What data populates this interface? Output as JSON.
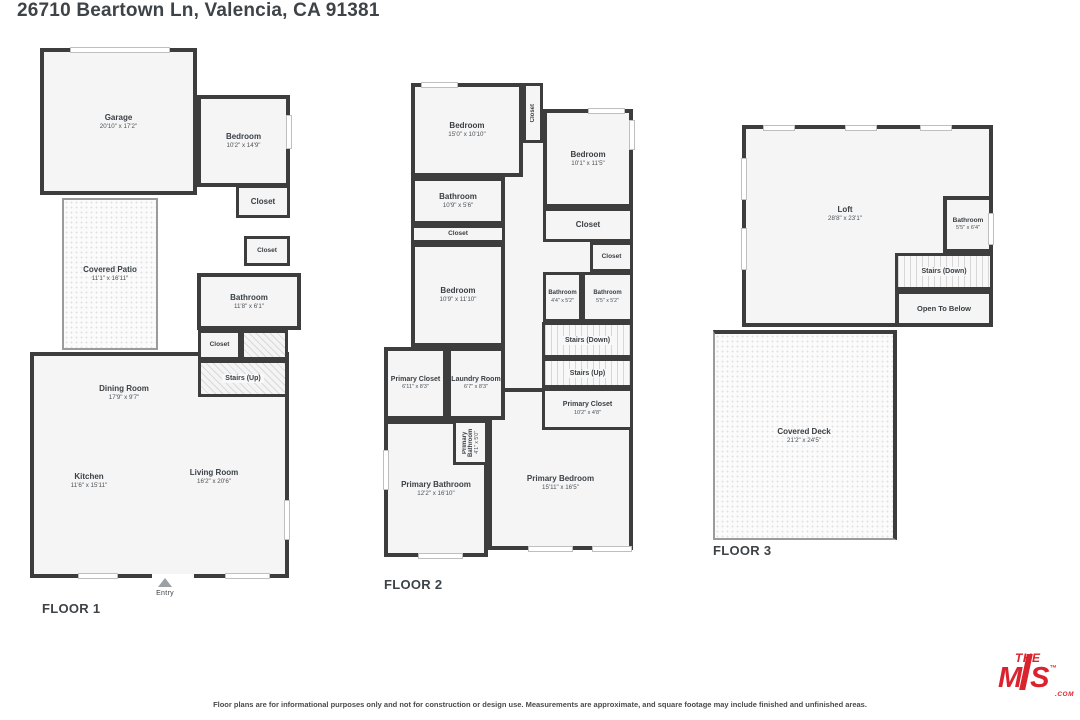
{
  "title": "26710 Beartown Ln, Valencia, CA 91381",
  "floors": [
    {
      "label": "FLOOR 1",
      "entry": "Entry",
      "rooms": [
        {
          "name": "Garage",
          "dims": "20'10\" x 17'2\""
        },
        {
          "name": "Bedroom",
          "dims": "10'2\" x 14'9\""
        },
        {
          "name": "Closet",
          "dims": ""
        },
        {
          "name": "Closet",
          "dims": ""
        },
        {
          "name": "Covered Patio",
          "dims": "11'1\" x 16'11\""
        },
        {
          "name": "Bathroom",
          "dims": "11'8\" x 6'1\""
        },
        {
          "name": "Closet",
          "dims": ""
        },
        {
          "name": "Stairs (Up)",
          "dims": ""
        },
        {
          "name": "Dining Room",
          "dims": "17'9\" x 9'7\""
        },
        {
          "name": "Kitchen",
          "dims": "11'6\" x 15'11\""
        },
        {
          "name": "Living Room",
          "dims": "16'2\" x 20'6\""
        }
      ]
    },
    {
      "label": "FLOOR 2",
      "rooms": [
        {
          "name": "Bedroom",
          "dims": "15'0\" x 10'10\""
        },
        {
          "name": "Closet",
          "dims": ""
        },
        {
          "name": "Bedroom",
          "dims": "10'1\" x 11'5\""
        },
        {
          "name": "Bathroom",
          "dims": "10'9\" x 5'6\""
        },
        {
          "name": "Closet",
          "dims": ""
        },
        {
          "name": "Closet",
          "dims": ""
        },
        {
          "name": "Closet",
          "dims": ""
        },
        {
          "name": "Bedroom",
          "dims": "10'9\" x 11'10\""
        },
        {
          "name": "Bathroom",
          "dims": "4'4\" x 5'2\""
        },
        {
          "name": "Bathroom",
          "dims": "5'5\" x 5'2\""
        },
        {
          "name": "Stairs (Down)",
          "dims": ""
        },
        {
          "name": "Stairs (Up)",
          "dims": ""
        },
        {
          "name": "Primary Closet",
          "dims": "6'11\" x 8'3\""
        },
        {
          "name": "Laundry Room",
          "dims": "6'7\" x 8'3\""
        },
        {
          "name": "Primary Closet",
          "dims": "10'2\" x 4'8\""
        },
        {
          "name": "Primary Bathroom",
          "dims": "4'1\" x 5'0\""
        },
        {
          "name": "Primary Bathroom",
          "dims": "12'2\" x 16'10\""
        },
        {
          "name": "Primary Bedroom",
          "dims": "15'11\" x 16'5\""
        }
      ]
    },
    {
      "label": "FLOOR 3",
      "rooms": [
        {
          "name": "Loft",
          "dims": "28'8\" x 23'1\""
        },
        {
          "name": "Bathroom",
          "dims": "5'5\" x 6'4\""
        },
        {
          "name": "Stairs (Down)",
          "dims": ""
        },
        {
          "name": "Open To Below",
          "dims": ""
        },
        {
          "name": "Covered Deck",
          "dims": "21'2\" x 24'5\""
        }
      ]
    }
  ],
  "footer": {
    "disclaimer": "Floor plans are for informational purposes only and not for construction or design use. Measurements are approximate, and square footage may include finished and unfinished areas."
  },
  "logo": {
    "the": "THE",
    "m": "M",
    "s": "S",
    "tm": "™",
    "com": ".COM"
  },
  "colors": {
    "wall": "#3d3d3d",
    "room_fill": "#f5f5f5",
    "logo_red": "#d9232e"
  }
}
